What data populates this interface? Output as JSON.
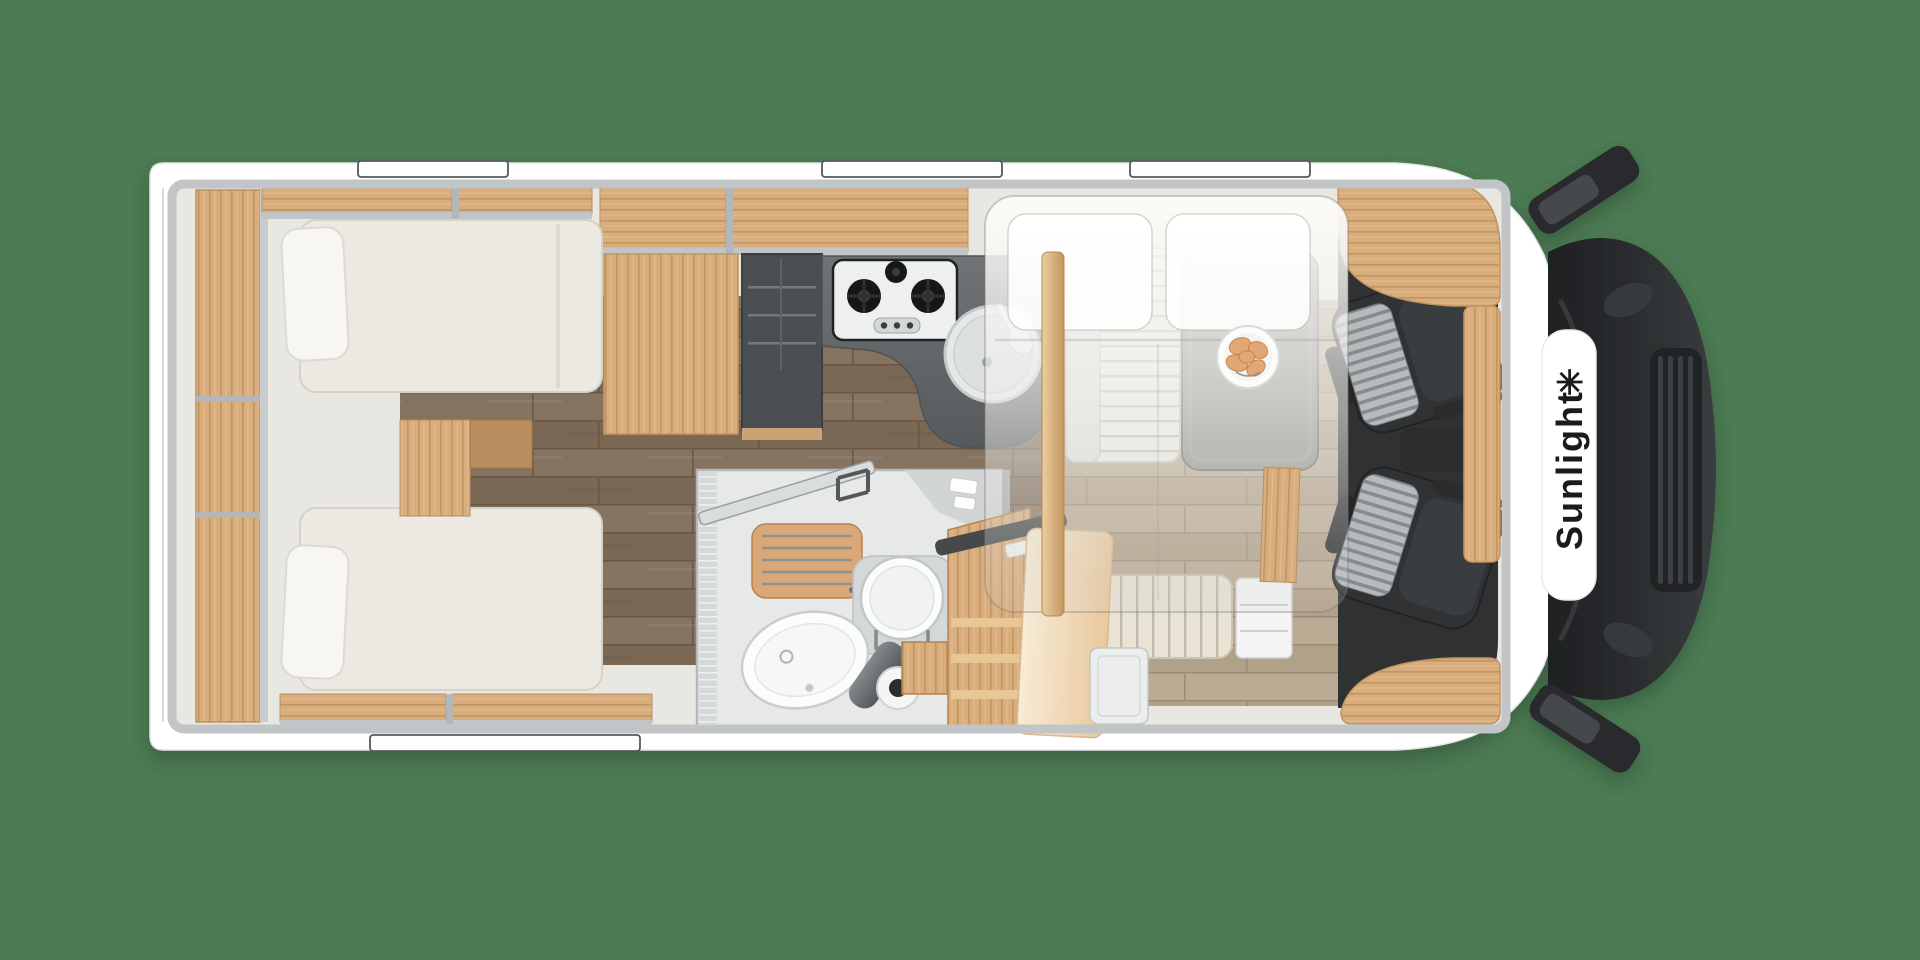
{
  "brand": {
    "name": "Sunlight",
    "logo_glyph": "✳"
  },
  "colors": {
    "bg-green": "#4d7b53",
    "body-white": "#ffffff",
    "wall-gray": "#c2c5c7",
    "interior-base": "#e9e7e2",
    "wood-light": "#dcae7e",
    "wood-mid": "#c79a63",
    "floor-dark": "#85735f",
    "floor-light": "#bcab94",
    "counter-gray": "#65696b",
    "fridge-gray": "#4b4f51",
    "mattress-cream": "#ebe9e1",
    "cab-dark": "#2f3133",
    "seat-stripe-light": "#b7bbbd",
    "overlay-white": "#f7f6f3",
    "door-beige": "#eed7b4",
    "hood-dark": "#26282a",
    "fixture-white": "#fbfcfc",
    "brand-text": "#1b1b1b",
    "croissant": "#e2a873"
  },
  "fixtures": [
    "rear-wall-shelf",
    "overhead-lockers",
    "single-bed-top",
    "single-bed-bottom",
    "bed-pillow",
    "bed-steps",
    "tall-fridge-cabinet",
    "kitchen-counter",
    "gas-hob-3-burner",
    "round-sink",
    "dinette-bench",
    "dinette-table",
    "breakfast-plate",
    "drop-down-bed-overlay",
    "wardrobe-entry-steps",
    "entrance-door-open",
    "bathroom",
    "shower-grate",
    "toilet",
    "washbasin",
    "bathroom-faucet",
    "cab-swivel-seat-left",
    "cab-swivel-seat-right",
    "dashboard-wood-trim",
    "windshield-hood",
    "side-mirror-top",
    "side-mirror-bottom",
    "window-top-1",
    "window-top-2",
    "window-top-3",
    "window-bottom-1",
    "entry-step-well"
  ]
}
